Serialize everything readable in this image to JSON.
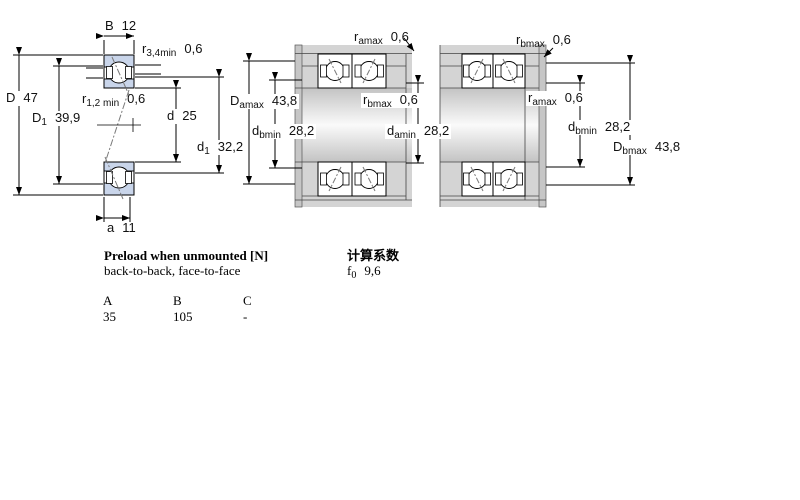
{
  "diagram": {
    "left_figure": {
      "labels": {
        "B": {
          "base": "B",
          "sub": "",
          "value": "12"
        },
        "D": {
          "base": "D",
          "sub": "",
          "value": "47"
        },
        "D1": {
          "base": "D",
          "sub": "1",
          "value": "39,9"
        },
        "r34": {
          "base": "r",
          "sub": "3,4min",
          "value": "0,6"
        },
        "r12": {
          "base": "r",
          "sub": "1,2 min",
          "value": "0,6"
        },
        "d": {
          "base": "d",
          "sub": "",
          "value": "25"
        },
        "d1": {
          "base": "d",
          "sub": "1",
          "value": "32,2"
        },
        "a": {
          "base": "a",
          "sub": "",
          "value": "11"
        }
      }
    },
    "middle_figure": {
      "labels": {
        "ramax": {
          "base": "r",
          "sub": "amax",
          "value": "0,6"
        },
        "Damax": {
          "base": "D",
          "sub": "amax",
          "value": "43,8"
        },
        "dbmin": {
          "base": "d",
          "sub": "bmin",
          "value": "28,2"
        },
        "rbmax": {
          "base": "r",
          "sub": "bmax",
          "value": "0,6"
        },
        "damin": {
          "base": "d",
          "sub": "amin",
          "value": "28,2"
        }
      }
    },
    "right_figure": {
      "labels": {
        "rbmax": {
          "base": "r",
          "sub": "bmax",
          "value": "0,6"
        },
        "ramax": {
          "base": "r",
          "sub": "amax",
          "value": "0,6"
        },
        "dbmin": {
          "base": "d",
          "sub": "bmin",
          "value": "28,2"
        },
        "Dbmax": {
          "base": "D",
          "sub": "bmax",
          "value": "43,8"
        }
      }
    },
    "colors": {
      "bearing_blue": "#c9d5ea",
      "housing_gray": "#d4d4d4",
      "line_black": "#000000"
    }
  },
  "preload": {
    "title": "Preload when unmounted [N]",
    "subtitle": "back-to-back, face-to-face",
    "columns": [
      "A",
      "B",
      "C"
    ],
    "values": [
      "35",
      "105",
      "-"
    ]
  },
  "calculation": {
    "title": "计算系数",
    "f0": {
      "base": "f",
      "sub": "0",
      "value": "9,6"
    }
  }
}
